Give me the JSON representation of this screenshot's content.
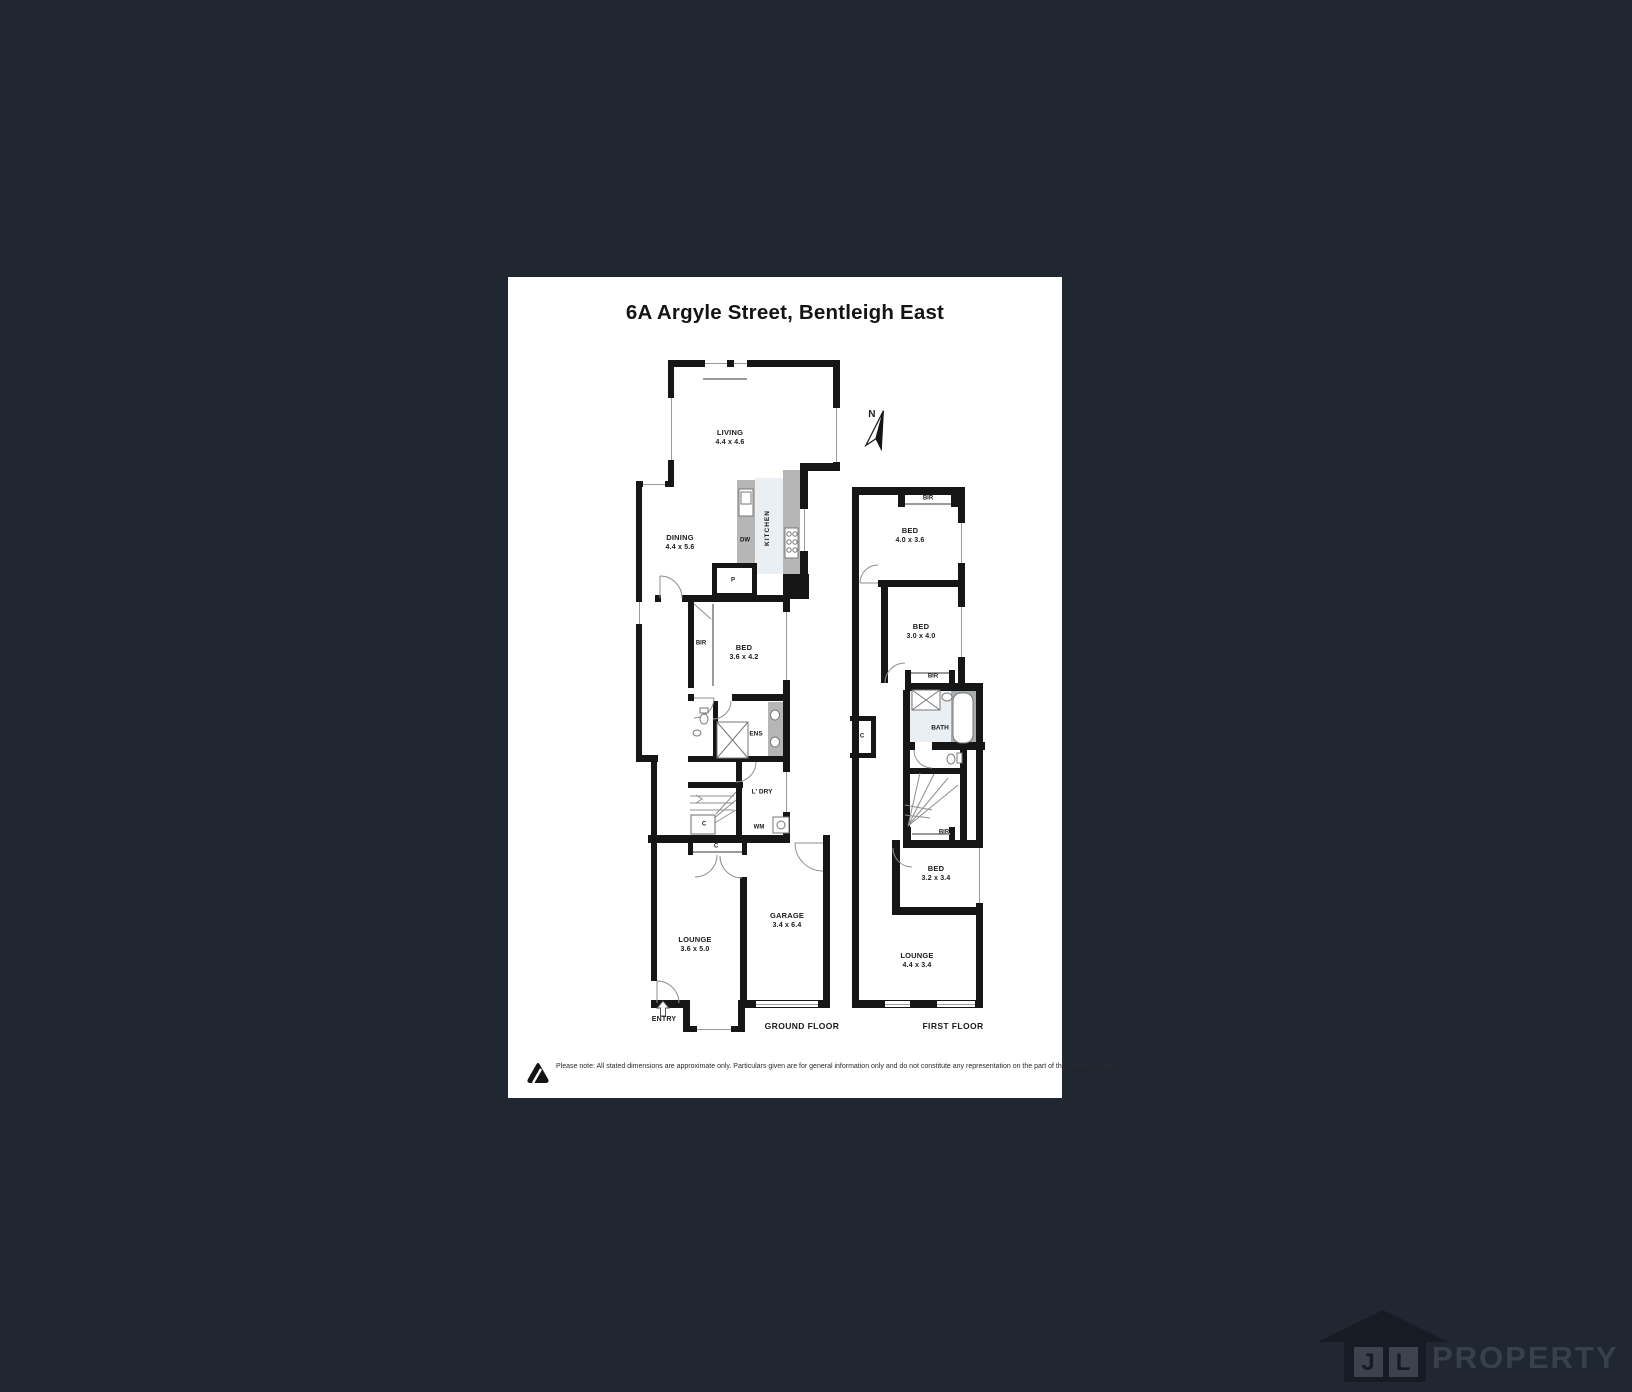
{
  "page": {
    "title": "6A Argyle Street, Bentleigh East"
  },
  "compass": {
    "label": "N"
  },
  "ground_floor": {
    "caption": "GROUND FLOOR",
    "living": {
      "name": "LIVING",
      "dims": "4.4 x 4.6"
    },
    "dining": {
      "name": "DINING",
      "dims": "4.4 x 5.6"
    },
    "kitchen": {
      "name": "KITCHEN",
      "dishwasher": "DW",
      "pantry": "P"
    },
    "bed": {
      "name": "BED",
      "dims": "3.6 x 4.2"
    },
    "bir": "BIR",
    "ens": "ENS",
    "laundry": {
      "name": "L' DRY",
      "washer": "WM"
    },
    "closet_understair": "C",
    "closet_hall": "C",
    "lounge": {
      "name": "LOUNGE",
      "dims": "3.6 x 5.0"
    },
    "garage": {
      "name": "GARAGE",
      "dims": "3.4 x 6.4"
    },
    "entry": "ENTRY"
  },
  "first_floor": {
    "caption": "FIRST FLOOR",
    "bir_bed1": "BIR",
    "bed1": {
      "name": "BED",
      "dims": "4.0 x 3.6"
    },
    "bed2": {
      "name": "BED",
      "dims": "3.0 x 4.0"
    },
    "bir_bed2": "BIR",
    "bath": "BATH",
    "closet": "C",
    "bir_bed3": "BIR",
    "bed3": {
      "name": "BED",
      "dims": "3.2 x 3.4"
    },
    "lounge": {
      "name": "LOUNGE",
      "dims": "4.4 x 3.4"
    }
  },
  "footer": {
    "disclaimer": "Please note: All stated dimensions are approximate only. Particulars given are for general information only and do not constitute any representation on the part of the vendor or agent."
  },
  "watermark": {
    "initial_j": "J",
    "initial_l": "L",
    "brand": "PROPERTY"
  },
  "colors": {
    "background": "#212731",
    "panel": "#ffffff",
    "wall": "#161616",
    "bench": "#b6b6b6",
    "wet_floor": "#e9eff2",
    "tub_surround": "#a8adb0"
  }
}
